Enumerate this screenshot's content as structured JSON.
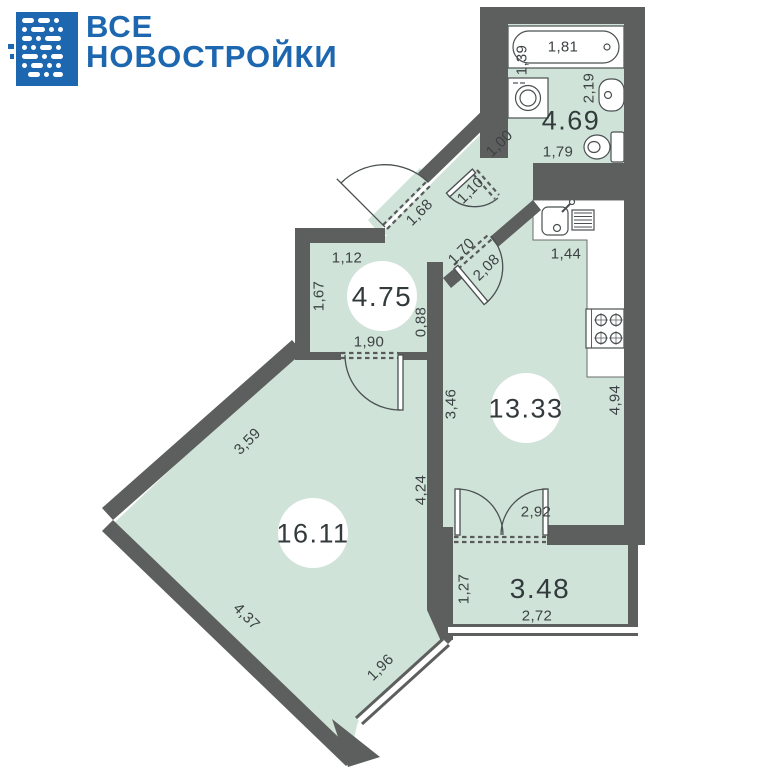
{
  "logo": {
    "line1": "ВСЕ",
    "line2": "НОВОСТРОЙКИ"
  },
  "plan": {
    "areas": {
      "bathroom": "4.69",
      "hallway": "4.75",
      "kitchen": "13.33",
      "living": "16.11",
      "balcony": "3.48"
    },
    "dims": {
      "tub_length": "1,81",
      "tub_width": "1,39",
      "bath_side": "2,19",
      "bath_bottom": "1,79",
      "vestibule_width": "1,00",
      "bath_door": "1,10",
      "entry_door": "1,68",
      "hall_top": "1,12",
      "hall_left": "1,67",
      "kitchen_door_width": "1,70",
      "kitchen_door": "2,08",
      "hall_nook": "0,88",
      "hall_living_door": "1,90",
      "kitchen_counter": "1,44",
      "kitchen_left": "3,46",
      "kitchen_right": "4,94",
      "living_nw": "3,59",
      "living_right": "4,24",
      "living_sw": "4,37",
      "living_window": "1,96",
      "balcony_door": "2,92",
      "balcony_left": "1,27",
      "balcony_bottom": "2,72"
    }
  },
  "colors": {
    "brand_blue": "#1c67af",
    "floor_green": "#cfe3d8",
    "wall_gray": "#5d5f5e",
    "dim_text": "#3c4244"
  }
}
